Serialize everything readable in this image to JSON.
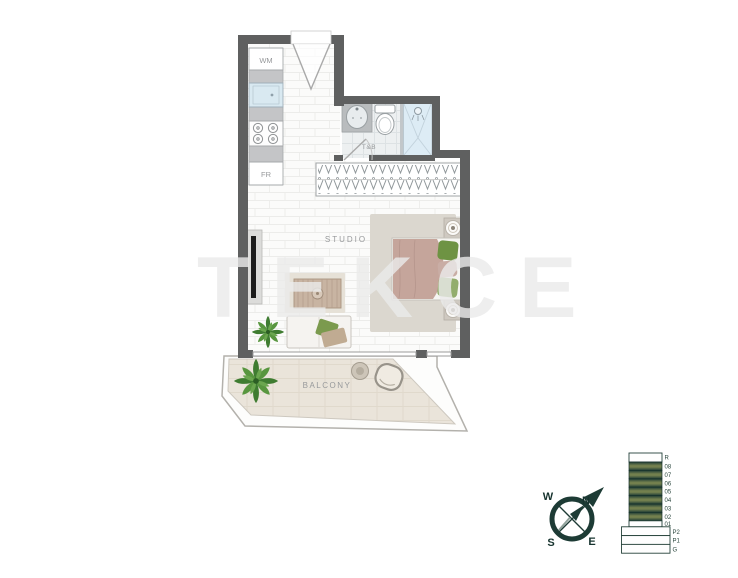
{
  "watermark": "TEKCE",
  "plan": {
    "labels": {
      "washer": "WM",
      "fridge": "FR",
      "bath": "T&B",
      "studio": "STUDIO",
      "balcony": "BALCONY"
    },
    "colors": {
      "wall": "#5f6060",
      "bed_blanket": "#c5a59b",
      "balcony_floor": "#eae4da",
      "plant_green": "#4e8c3c",
      "accent_teal": "#1d3b35",
      "shower_blue": "#ddecf5"
    }
  },
  "compass": {
    "north": "N",
    "east": "E",
    "south": "S",
    "west": "W"
  },
  "building": {
    "floors": [
      {
        "label": "R",
        "type": "roof"
      },
      {
        "label": "08",
        "type": "unit"
      },
      {
        "label": "07",
        "type": "unit"
      },
      {
        "label": "06",
        "type": "unit"
      },
      {
        "label": "05",
        "type": "unit"
      },
      {
        "label": "04",
        "type": "unit"
      },
      {
        "label": "03",
        "type": "unit"
      },
      {
        "label": "02",
        "type": "unit"
      },
      {
        "label": "01",
        "type": "tower-base"
      },
      {
        "label": "P2",
        "type": "podium"
      },
      {
        "label": "P1",
        "type": "podium"
      },
      {
        "label": "G",
        "type": "podium"
      }
    ]
  }
}
